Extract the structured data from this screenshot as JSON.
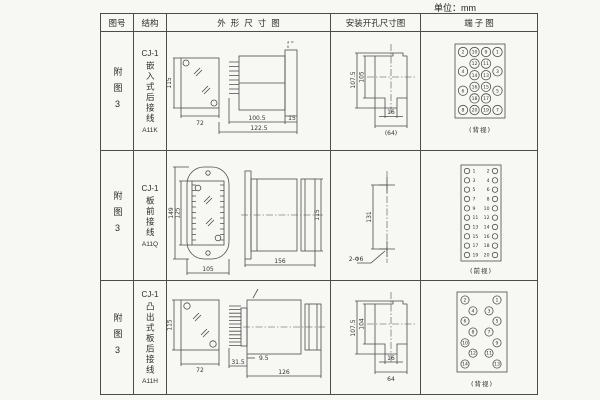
{
  "unit_label": "单位：mm",
  "headers": {
    "fig_no": "图号",
    "structure": "结构",
    "outline": "外形尺寸图",
    "mounting": "安装开孔尺寸图",
    "terminal": "端子图"
  },
  "rows": [
    {
      "fig_no": "附图3",
      "model": "CJ-1",
      "structure": "嵌入式后接线",
      "code": "A11K",
      "outline": {
        "front_h": "115",
        "front_w": "72",
        "body_len": "100.5",
        "total_len": "122.5",
        "flange": "15"
      },
      "mounting": {
        "outer_h": "107.5",
        "inner_h": "105",
        "slot_w": "16",
        "width": "(64)"
      },
      "terminal": {
        "caption": "(背视)",
        "items": [
          {
            "n": "2",
            "c": 0,
            "r": 0
          },
          {
            "n": "4",
            "c": 0,
            "r": 0.333
          },
          {
            "n": "6",
            "c": 0,
            "r": 0.667
          },
          {
            "n": "8",
            "c": 0,
            "r": 1
          },
          {
            "n": "10",
            "c": 1,
            "r": 0
          },
          {
            "n": "12",
            "c": 1,
            "r": 0.2
          },
          {
            "n": "14",
            "c": 1,
            "r": 0.4
          },
          {
            "n": "16",
            "c": 1,
            "r": 0.6
          },
          {
            "n": "18",
            "c": 1,
            "r": 0.8
          },
          {
            "n": "20",
            "c": 1,
            "r": 1
          },
          {
            "n": "9",
            "c": 2,
            "r": 0
          },
          {
            "n": "11",
            "c": 2,
            "r": 0.2
          },
          {
            "n": "13",
            "c": 2,
            "r": 0.4
          },
          {
            "n": "15",
            "c": 2,
            "r": 0.6
          },
          {
            "n": "17",
            "c": 2,
            "r": 0.8
          },
          {
            "n": "19",
            "c": 2,
            "r": 1
          },
          {
            "n": "1",
            "c": 3,
            "r": 0
          },
          {
            "n": "3",
            "c": 3,
            "r": 0.333
          },
          {
            "n": "5",
            "c": 3,
            "r": 0.667
          },
          {
            "n": "7",
            "c": 3,
            "r": 1
          }
        ]
      }
    },
    {
      "fig_no": "附图3",
      "model": "CJ-1",
      "structure": "板前接线",
      "code": "A11Q",
      "outline": {
        "front_h": "149",
        "inner_h": "125",
        "front_w": "105",
        "body_len": "156",
        "body_h": "115"
      },
      "mounting": {
        "hole_dist": "131",
        "hole_label": "2-Φ6"
      },
      "terminal": {
        "caption": "(前视)",
        "left": [
          "1",
          "3",
          "5",
          "7",
          "9",
          "11",
          "13",
          "15",
          "17",
          "19"
        ],
        "right": [
          "2",
          "4",
          "6",
          "8",
          "10",
          "12",
          "14",
          "16",
          "18",
          "20"
        ]
      }
    },
    {
      "fig_no": "附图3",
      "model": "CJ-1",
      "structure": "凸出式板后接线",
      "code": "A11H",
      "outline": {
        "front_h": "115",
        "front_w": "72",
        "pin_len": "31.5",
        "offset": "9.5",
        "body_len": "126"
      },
      "mounting": {
        "outer_h": "107.5",
        "inner_h": "104",
        "slot_w": "16",
        "width": "64"
      },
      "terminal": {
        "caption": "(背视)",
        "items": [
          {
            "n": "2",
            "c": 0,
            "r": 0
          },
          {
            "n": "6",
            "c": 0,
            "r": 0.33
          },
          {
            "n": "10",
            "c": 0,
            "r": 0.67
          },
          {
            "n": "14",
            "c": 0,
            "r": 1
          },
          {
            "n": "4",
            "c": 1,
            "r": 0.17
          },
          {
            "n": "8",
            "c": 1,
            "r": 0.5
          },
          {
            "n": "12",
            "c": 1,
            "r": 0.83
          },
          {
            "n": "3",
            "c": 2,
            "r": 0.17
          },
          {
            "n": "7",
            "c": 2,
            "r": 0.5
          },
          {
            "n": "11",
            "c": 2,
            "r": 0.83
          },
          {
            "n": "1",
            "c": 3,
            "r": 0
          },
          {
            "n": "5",
            "c": 3,
            "r": 0.33
          },
          {
            "n": "9",
            "c": 3,
            "r": 0.67
          },
          {
            "n": "13",
            "c": 3,
            "r": 1
          }
        ]
      }
    }
  ]
}
